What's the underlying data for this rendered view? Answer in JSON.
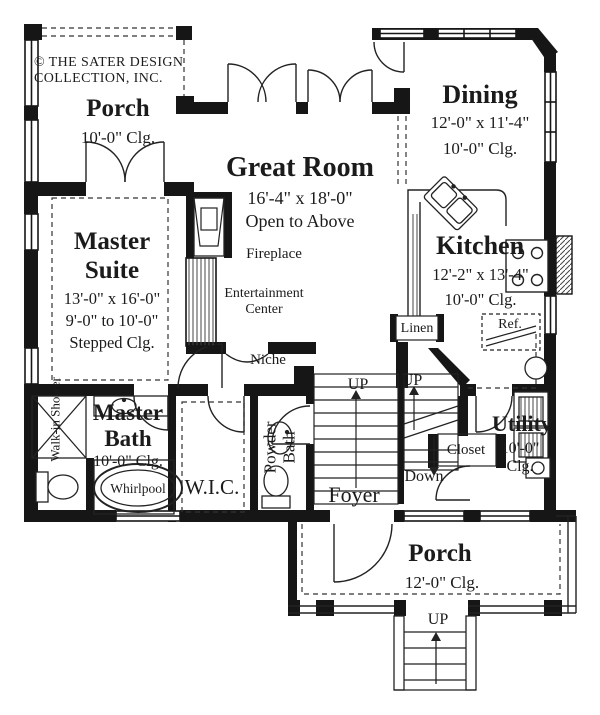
{
  "copyright": "© THE SATER DESIGN COLLECTION, INC.",
  "rooms": {
    "porch_upper": {
      "name": "Porch",
      "clg": "10'-0\" Clg."
    },
    "dining": {
      "name": "Dining",
      "dims": "12'-0\" x 11'-4\"",
      "clg": "10'-0\" Clg."
    },
    "great_room": {
      "name": "Great Room",
      "dims": "16'-4\" x 18'-0\"",
      "note": "Open to Above"
    },
    "master_suite": {
      "name": "Master Suite",
      "dims": "13'-0\" x 16'-0\"",
      "clg_range": "9'-0\" to 10'-0\"",
      "clg": "Stepped Clg."
    },
    "kitchen": {
      "name": "Kitchen",
      "dims": "12'-2\" x 13'-4\"",
      "clg": "10'-0\" Clg."
    },
    "master_bath": {
      "name": "Master Bath",
      "clg": "10'-0\" Clg."
    },
    "wic": {
      "name": "W.I.C."
    },
    "powder_bath": {
      "name": "Powder Bath"
    },
    "foyer": {
      "name": "Foyer"
    },
    "utility": {
      "name": "Utility",
      "clg": "10'-0\" Clg."
    },
    "porch_lower": {
      "name": "Porch",
      "clg": "12'-0\" Clg."
    }
  },
  "labels": {
    "fireplace": "Fireplace",
    "entertainment_center": "Entertainment Center",
    "niche": "Niche",
    "linen": "Linen",
    "ref": "Ref.",
    "closet": "Closet",
    "whirlpool": "Whirlpool",
    "walk_in_shower": "Walk-in Shower",
    "stair_up_left": "UP",
    "stair_up_right": "UP",
    "stair_down": "Down",
    "porch_steps_up": "UP"
  },
  "colors": {
    "line": "#1c1c1c",
    "text": "#1b1b1b",
    "background": "#ffffff"
  }
}
